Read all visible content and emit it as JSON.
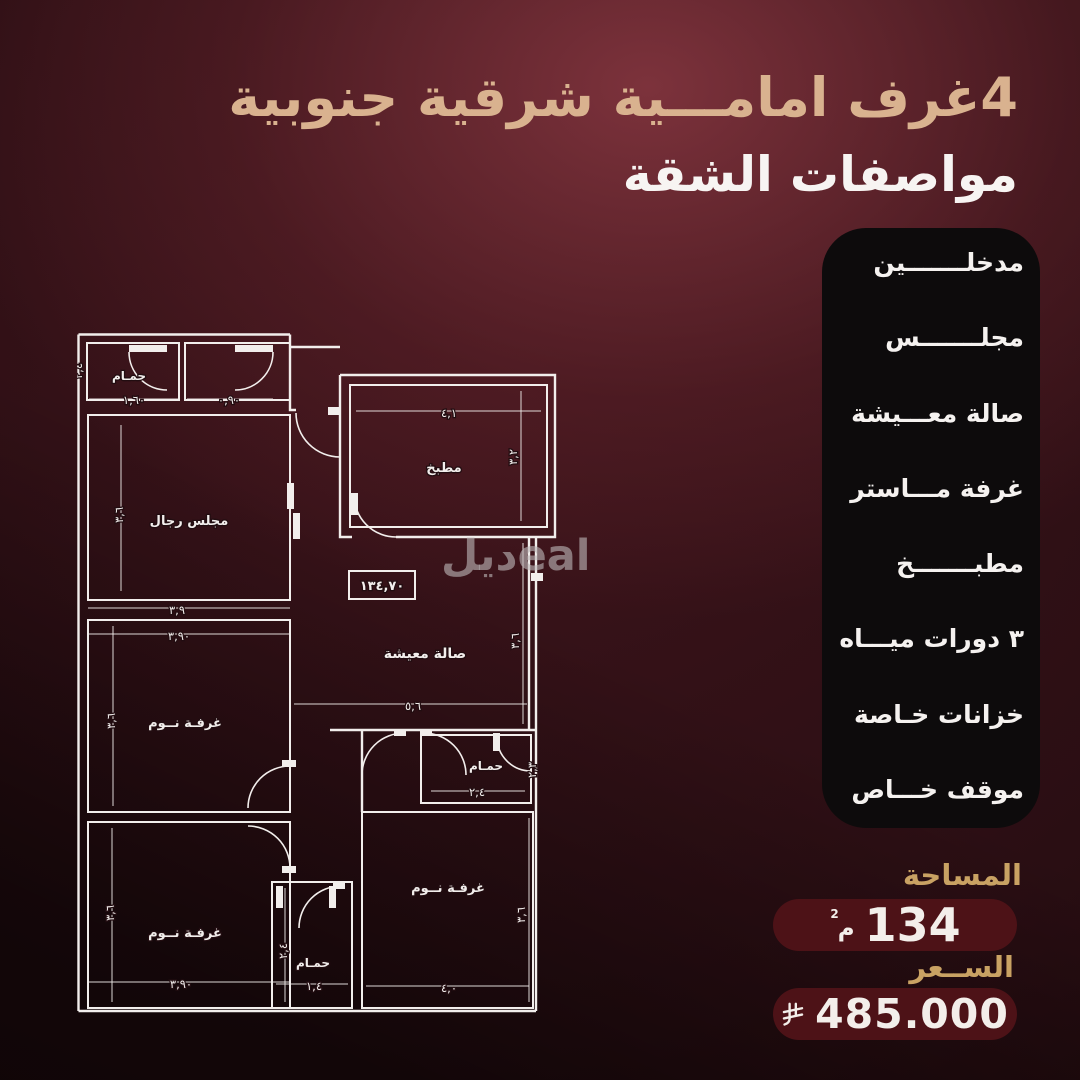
{
  "header": {
    "title": "4غرف امامـــية شرقية جنوبية",
    "subtitle": "مواصفات الشقة"
  },
  "features": [
    "مدخلـــــــين",
    "مجلـــــــس",
    "صالة معـــيشة",
    "غرفة مـــاستر",
    "مطبـــــــخ",
    "٣ دورات ميـــاه",
    "خزانات خـاصة",
    "موقف خـــاص"
  ],
  "area": {
    "label": "المساحة",
    "value": "134",
    "unit": "م",
    "unit_sup": "2"
  },
  "price": {
    "label": "الســعر",
    "value": "485.000",
    "currency_icon": "saudi-riyal-symbol"
  },
  "watermark": {
    "ar": "ديل",
    "latin": "eal"
  },
  "floorplan": {
    "area_box": "١٣٤,٧٠",
    "rooms": [
      {
        "id": "bath_tl",
        "label": "حمـام"
      },
      {
        "id": "majlis",
        "label": "مجلس رجال"
      },
      {
        "id": "kitchen",
        "label": "مطبخ"
      },
      {
        "id": "living",
        "label": "صالة معيشة"
      },
      {
        "id": "bed_ml",
        "label": "غرفـة نــوم"
      },
      {
        "id": "bed_bl",
        "label": "غرفـة نــوم"
      },
      {
        "id": "bath_bm",
        "label": "حمـام"
      },
      {
        "id": "bed_br",
        "label": "غرفـة نــوم"
      },
      {
        "id": "bath_br",
        "label": "حمـام"
      }
    ],
    "dims": [
      {
        "id": "bath_tl_w",
        "text": "١,٦٠"
      },
      {
        "id": "closet_w",
        "text": "٠,٩٠"
      },
      {
        "id": "bath_tl_h",
        "text": "٢,٤"
      },
      {
        "id": "majlis_w",
        "text": "٣,٩"
      },
      {
        "id": "majlis_h",
        "text": "٣,٦"
      },
      {
        "id": "kitchen_w",
        "text": "٤,١"
      },
      {
        "id": "kitchen_h",
        "text": "٣,٢"
      },
      {
        "id": "bed_ml_w",
        "text": "٣,٩٠"
      },
      {
        "id": "bed_ml_h",
        "text": "٣,٦"
      },
      {
        "id": "living_w",
        "text": "٥,٦"
      },
      {
        "id": "living_h",
        "text": "٣,٦"
      },
      {
        "id": "bed_bl_w",
        "text": "٣,٩٠"
      },
      {
        "id": "bed_bl_h",
        "text": "٣,٦"
      },
      {
        "id": "bath_bm_w",
        "text": "١,٤"
      },
      {
        "id": "bath_bm_h",
        "text": "٢,٤"
      },
      {
        "id": "bed_br_w",
        "text": "٤,٠"
      },
      {
        "id": "bed_br_h",
        "text": "٣,٦"
      },
      {
        "id": "bath_br_w",
        "text": "٢,٤"
      },
      {
        "id": "bath_br_h",
        "text": "٢,٣"
      }
    ]
  },
  "colors": {
    "accent_gold": "#d9b28f",
    "label_gold": "#c9a263",
    "pill_red": "#4d1217",
    "panel_black": "#0d0b0c",
    "line_white": "#f2eeec"
  }
}
